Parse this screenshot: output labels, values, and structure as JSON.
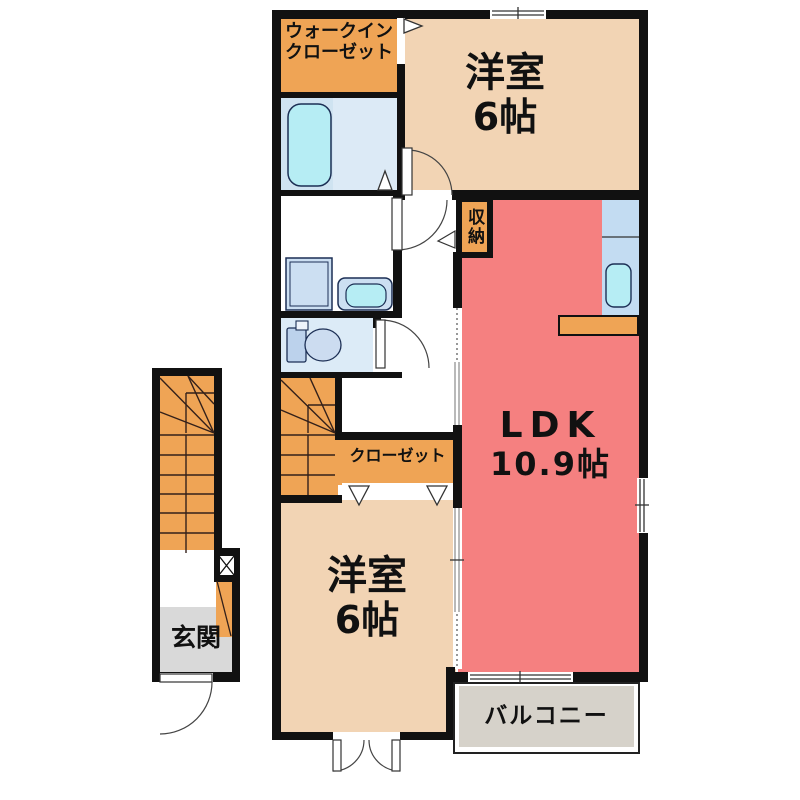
{
  "floorplan": {
    "title": "apartment-floor-plan",
    "rooms": {
      "walk_in_closet": {
        "label_line1": "ウォークイン",
        "label_line2": "クローゼット"
      },
      "bedroom_top": {
        "name": "洋室",
        "size": "6帖"
      },
      "storage": {
        "label": "収納"
      },
      "ldk": {
        "name": "LDK",
        "size": "10.9帖"
      },
      "closet": {
        "label": "クローゼット"
      },
      "bedroom_bottom": {
        "name": "洋室",
        "size": "6帖"
      },
      "balcony": {
        "label": "バルコニー"
      },
      "entrance": {
        "label": "玄関"
      }
    },
    "colors": {
      "wall": "#111111",
      "room_orange": "#efa455",
      "room_tan": "#f2d4b4",
      "ldk_salmon": "#f58080",
      "bath_blue": "#cfe3f1",
      "fixture_cyan": "#b6edf4",
      "kitchen_blue": "#c3dcf2",
      "entrance_gray": "#d9d9d9",
      "balcony_gray": "#d6d2ca"
    }
  }
}
